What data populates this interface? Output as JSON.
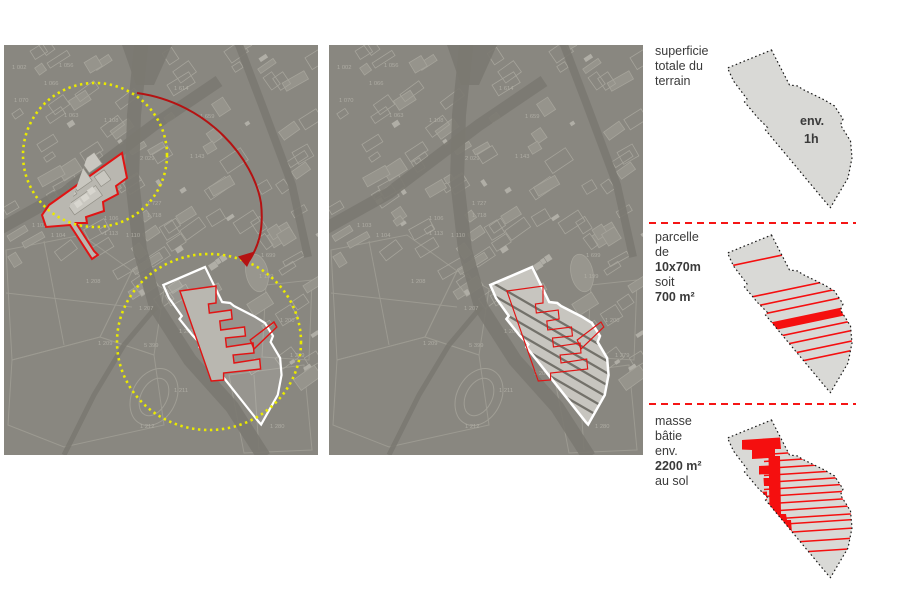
{
  "page": {
    "background": "#ffffff"
  },
  "colors": {
    "map_bg": "#898780",
    "map_line": "#a6a49b",
    "map_fill": "#96948c",
    "map_building": "#b9b7b0",
    "map_building_inner": "#c9c7c0",
    "map_building_bright": "#d8d6cf",
    "road": "#7b7971",
    "label": "#aeaca3",
    "yellow": "#eaea00",
    "red": "#e11414",
    "arrow_red": "#b51212",
    "legend_red": "#f50f0f",
    "separator_red": "#f51515",
    "terrain_fill": "#d9d9d6",
    "terrain_fill_map": "#c7c5bf",
    "terrain_outline_map": "#ffffff",
    "stripe_dark": "#73716a",
    "outline_dotted": "#1a1a1a",
    "text": "#3a3a3a"
  },
  "maps": {
    "left": {
      "name": "cadastral situation map with two highlighted sites, yellow dotted circles and red relocation arrow"
    },
    "middle": {
      "name": "cadastral map with terrain parcel overlay (white outline, dark stripes, red footprint)"
    },
    "parcel_labels": [
      {
        "t": "1 002",
        "x": 8,
        "y": 24
      },
      {
        "t": "1 056",
        "x": 55,
        "y": 22
      },
      {
        "t": "1 066",
        "x": 40,
        "y": 40
      },
      {
        "t": "1 070",
        "x": 10,
        "y": 57
      },
      {
        "t": "1 063",
        "x": 60,
        "y": 72
      },
      {
        "t": "1 614",
        "x": 170,
        "y": 45
      },
      {
        "t": "1 659",
        "x": 196,
        "y": 73
      },
      {
        "t": "1 143",
        "x": 186,
        "y": 113
      },
      {
        "t": "2 029",
        "x": 136,
        "y": 115
      },
      {
        "t": "1 108",
        "x": 100,
        "y": 77
      },
      {
        "t": "1 727",
        "x": 143,
        "y": 160
      },
      {
        "t": "1 718",
        "x": 143,
        "y": 172
      },
      {
        "t": "1 103",
        "x": 28,
        "y": 182
      },
      {
        "t": "1 106",
        "x": 100,
        "y": 175
      },
      {
        "t": "1 104",
        "x": 47,
        "y": 192
      },
      {
        "t": "1 113",
        "x": 100,
        "y": 190
      },
      {
        "t": "1 110",
        "x": 122,
        "y": 192
      },
      {
        "t": "1 208",
        "x": 82,
        "y": 238
      },
      {
        "t": "1 207",
        "x": 135,
        "y": 265
      },
      {
        "t": "1 206",
        "x": 175,
        "y": 288
      },
      {
        "t": "1 209",
        "x": 94,
        "y": 300
      },
      {
        "t": "5 399",
        "x": 140,
        "y": 302
      },
      {
        "t": "1 211",
        "x": 170,
        "y": 347
      },
      {
        "t": "1 212",
        "x": 136,
        "y": 383
      },
      {
        "t": "1 280",
        "x": 266,
        "y": 383
      },
      {
        "t": "1 279",
        "x": 286,
        "y": 312
      },
      {
        "t": "1 200",
        "x": 276,
        "y": 277
      },
      {
        "t": "1 699",
        "x": 257,
        "y": 212
      },
      {
        "t": "1 199",
        "x": 255,
        "y": 233
      },
      {
        "t": "1 206",
        "x": 205,
        "y": 330
      }
    ]
  },
  "legend": {
    "sections": [
      {
        "id": "superficie",
        "title_lines": [
          "superficie",
          "totale du",
          "terrain"
        ],
        "diagram_note_1": "env.",
        "diagram_note_2": "1h"
      },
      {
        "id": "parcelle",
        "title_lines": [
          "parcelle",
          "de",
          "10x70m",
          "soit",
          "700 m²"
        ]
      },
      {
        "id": "masse",
        "title_lines": [
          "masse",
          "bâtie",
          "env.",
          "2200 m²",
          "au sol"
        ]
      }
    ]
  }
}
